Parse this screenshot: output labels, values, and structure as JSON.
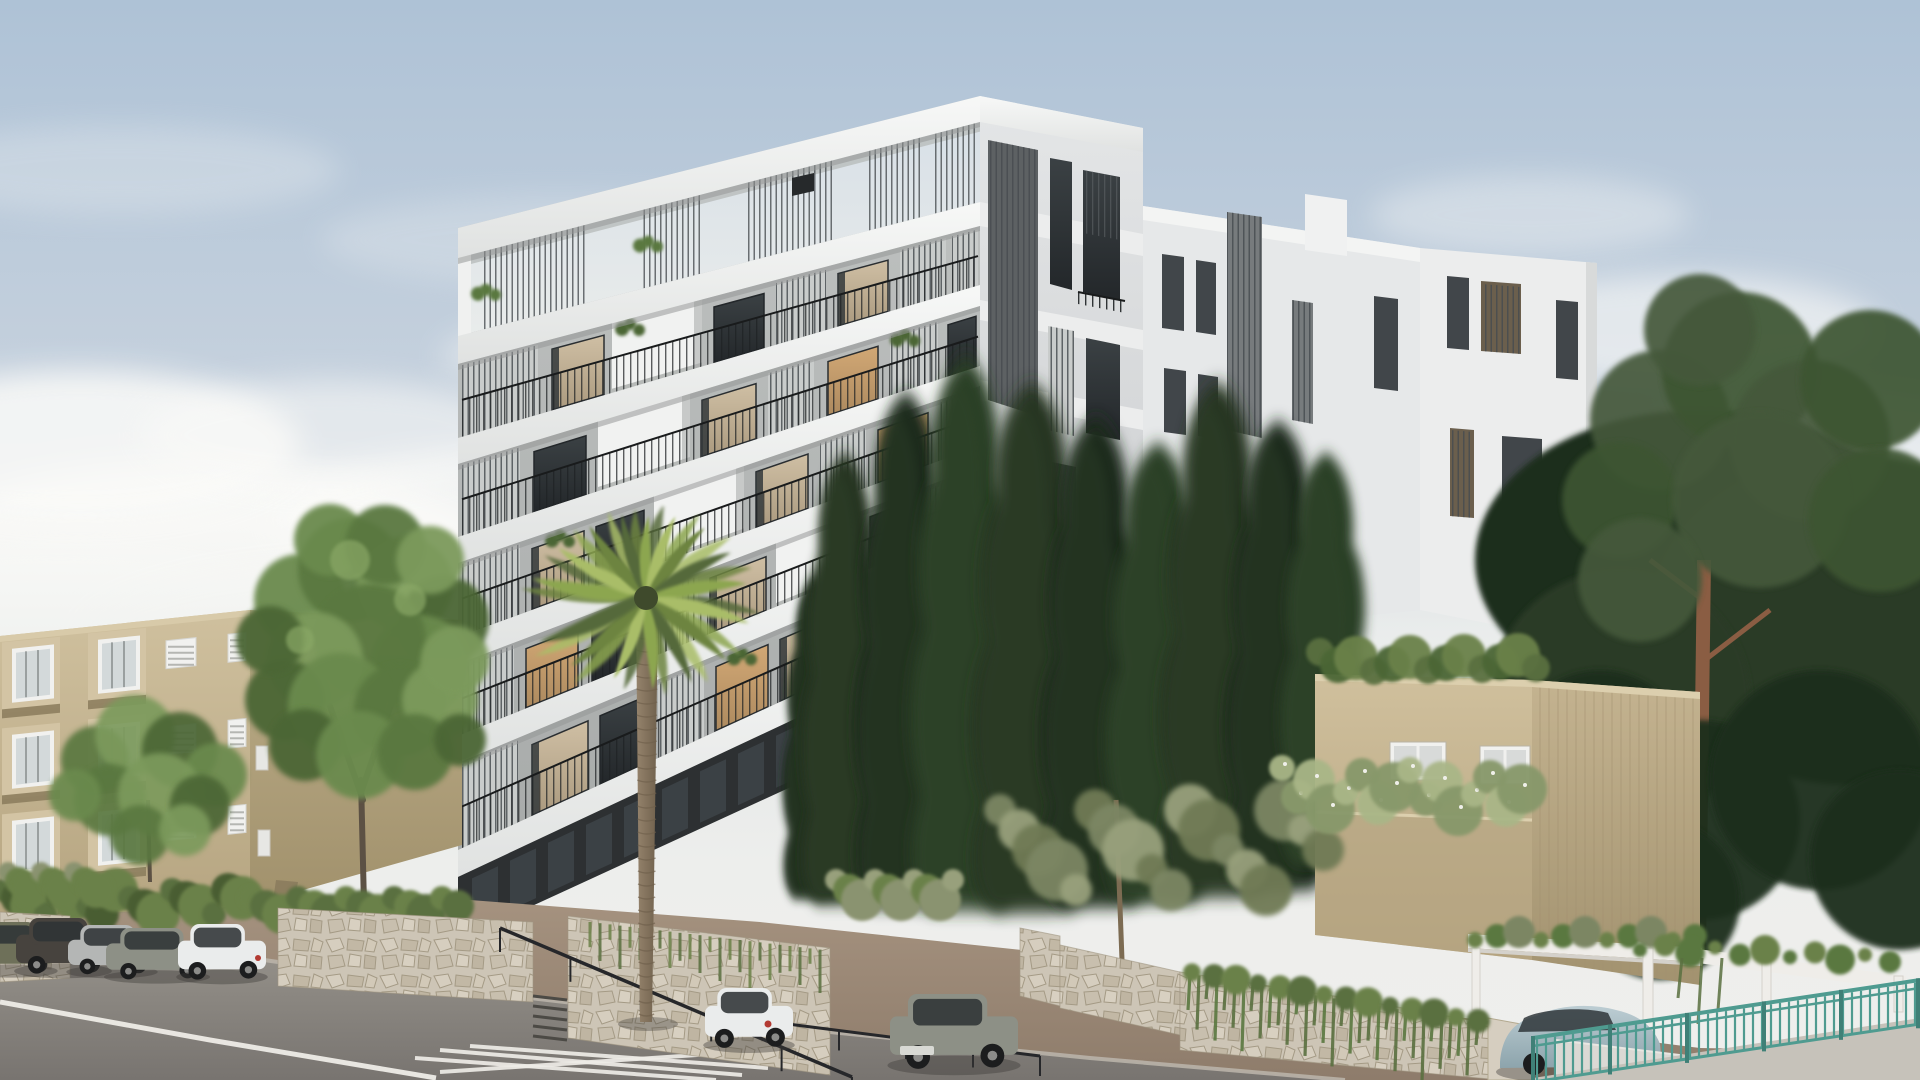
{
  "meta": {
    "title": "Architectural rendering: modern white apartment building street view",
    "scene_type": "photorealistic exterior visualization, daytime"
  },
  "palette": {
    "skyTop": "#aec2d6",
    "skyUpper": "#c7d2de",
    "skyMid": "#e3e6e7",
    "horizon": "#edeeec",
    "cloud": "#fafaf8",
    "slab": "#f4f5f4",
    "slabLow": "#e2e4e3",
    "slabShadow": "#959897",
    "wallGrey": "#b6b9b8",
    "wallGreyLight": "#c9cccb",
    "wallDeep": "#a7aaa9",
    "glassDark": "#383d40",
    "glassDeep": "#272b2d",
    "curtain": "#c9b99e",
    "curtainDark": "#b3a186",
    "litWindow": "#cda471",
    "louverLine": "#474c4f",
    "pickLine": "#1e2123",
    "groundFloor": "#2d3032",
    "groundPane": "#4a5257",
    "rightFace": "#d9dbdc",
    "rearA": "#e6e8e9",
    "rearB": "#eceded",
    "rearWin": "#41464a",
    "beigeFront": "#c7b794",
    "beigeSide": "#b0a17c",
    "bayBox": "#d3c4a4",
    "bayShadow": "#8d7e5e",
    "winWhite": "#f1f1ef",
    "winGlass": "#d3d9da",
    "strut": "#8d7e5f",
    "cantShadow": "#7b6d52",
    "houseFront": "#c9b996",
    "houseTall": "#bcab88",
    "houseTop": "#dccfae",
    "stone": "#cdc5b6",
    "stoneDark": "#b9af9d",
    "stoneLine": "#a49a85",
    "hedge1": "#5a7040",
    "hedge2": "#4a5d33",
    "hedge3": "#6b8148",
    "tree1": "#6b8a4e",
    "tree2": "#5a7840",
    "tree3": "#7b9a5c",
    "tree4": "#4c6636",
    "treeLight": "#8aa866",
    "cyp1": "#253521",
    "cyp2": "#1d2b1a",
    "cyp3": "#2c3f26",
    "cypHi": "#31452a",
    "olive1": "#7c8663",
    "olive2": "#98a07c",
    "olive3": "#6f7a55",
    "palm1": "#8ca64f",
    "palm2": "#a9bd68",
    "palm3": "#6d8440",
    "palm4": "#55693a",
    "palmCore": "#3f4a2c",
    "trunk": "#8b7962",
    "trunkDark": "#6e5f4c",
    "pineTrunk": "#8a5d43",
    "pine1": "#3c5430",
    "pine2": "#2a3b26",
    "pine3": "#1f2d1d",
    "pine4": "#44583a",
    "road": "#8a8683",
    "roadDark": "#7b7773",
    "roadEdge": "#b9b2a8",
    "roadLine": "#eeece7",
    "dirt": "#a08d7b",
    "dirtDark": "#8e7c6b",
    "teal": "#4f9b90",
    "pergola": "#efede9",
    "pergolaShade": "#d4d1cb",
    "railDark": "#26272a",
    "carWhite": "#eaecec",
    "carSilver": "#b4b6b5",
    "carGrey": "#8d9086",
    "carDark": "#47433e",
    "carOlive": "#6e7059",
    "carBlue": "#a7bdc5",
    "concrete": "#c6c2ba",
    "lowWall": "#dbd9d4"
  },
  "front": {
    "x0": 458,
    "x1": 980,
    "bottom": [
      940,
      700
    ],
    "bands": [
      [
        228,
        96,
        258,
        122
      ],
      [
        336,
        202,
        364,
        226
      ],
      [
        438,
        285,
        464,
        306
      ],
      [
        537,
        366,
        563,
        386
      ],
      [
        637,
        446,
        664,
        466
      ],
      [
        736,
        524,
        763,
        545
      ],
      [
        850,
        610,
        877,
        632
      ]
    ],
    "pergola": {
      "louvers": [
        [
          480,
          585
        ],
        [
          640,
          700
        ],
        [
          748,
          835
        ],
        [
          868,
          922
        ],
        [
          934,
          976
        ]
      ],
      "plants": [
        [
          486,
          0.5
        ],
        [
          648,
          0.42
        ]
      ],
      "slot": [
        792,
        178,
        22,
        18
      ]
    },
    "floors": [
      {
        "it": [
          [
            "lv",
            462,
            538,
            0.03,
            1
          ],
          [
            "wc",
            552,
            604,
            0.14,
            0.99
          ],
          [
            "wb",
            612,
            702,
            -0.05,
            1
          ],
          [
            "wd",
            714,
            764,
            0.16,
            0.99
          ],
          [
            "lv",
            776,
            826,
            0.05,
            1
          ],
          [
            "wc",
            838,
            888,
            0.16,
            0.99
          ],
          [
            "lv",
            900,
            946,
            0.05,
            1
          ],
          [
            "lv",
            952,
            978,
            0.05,
            1
          ],
          [
            "rl",
            462,
            978,
            0.5,
            1
          ],
          [
            "pl",
            630,
            0,
            0.08,
            0
          ]
        ]
      },
      {
        "it": [
          [
            "lv",
            462,
            520,
            0.03,
            1
          ],
          [
            "wd",
            534,
            586,
            0.15,
            0.99
          ],
          [
            "wb",
            598,
            690,
            -0.05,
            1
          ],
          [
            "wc",
            702,
            756,
            0.15,
            0.99
          ],
          [
            "lv",
            768,
            814,
            0.05,
            1
          ],
          [
            "wl",
            828,
            878,
            0.15,
            0.99
          ],
          [
            "lv",
            890,
            938,
            0.05,
            1
          ],
          [
            "wd",
            948,
            976,
            0.15,
            0.99
          ],
          [
            "rl",
            462,
            978,
            0.5,
            1
          ],
          [
            "pl",
            905,
            0,
            0.1,
            0
          ]
        ]
      },
      {
        "it": [
          [
            "lv",
            462,
            520,
            0.03,
            1
          ],
          [
            "wc",
            532,
            584,
            0.15,
            0.99
          ],
          [
            "wd",
            596,
            644,
            0.15,
            0.99
          ],
          [
            "wb",
            654,
            744,
            -0.05,
            1
          ],
          [
            "wc",
            756,
            808,
            0.15,
            0.99
          ],
          [
            "lv",
            820,
            866,
            0.05,
            1
          ],
          [
            "wl",
            878,
            928,
            0.15,
            0.99
          ],
          [
            "lv",
            940,
            976,
            0.05,
            1
          ],
          [
            "rl",
            462,
            978,
            0.5,
            1
          ],
          [
            "pl",
            560,
            0,
            0.1,
            0
          ]
        ]
      },
      {
        "it": [
          [
            "lv",
            462,
            514,
            0.03,
            1
          ],
          [
            "wl",
            526,
            578,
            0.15,
            0.99
          ],
          [
            "wd",
            592,
            638,
            0.15,
            0.99
          ],
          [
            "lv",
            650,
            698,
            0.05,
            1
          ],
          [
            "wc",
            710,
            766,
            0.15,
            0.99
          ],
          [
            "wb",
            776,
            858,
            -0.05,
            1
          ],
          [
            "wd",
            870,
            918,
            0.15,
            0.99
          ],
          [
            "lv",
            930,
            974,
            0.05,
            1
          ],
          [
            "rl",
            462,
            978,
            0.5,
            1
          ]
        ]
      },
      {
        "it": [
          [
            "lv",
            462,
            518,
            0.03,
            1
          ],
          [
            "wc",
            532,
            588,
            0.15,
            0.99
          ],
          [
            "wd",
            600,
            648,
            0.15,
            0.99
          ],
          [
            "lv",
            658,
            704,
            0.05,
            1
          ],
          [
            "wl",
            716,
            768,
            0.15,
            0.99
          ],
          [
            "wc",
            780,
            834,
            0.15,
            0.99
          ],
          [
            "lv",
            846,
            892,
            0.05,
            1
          ],
          [
            "wd",
            902,
            948,
            0.15,
            0.99
          ],
          [
            "lv",
            956,
            978,
            0.05,
            1
          ],
          [
            "rl",
            462,
            978,
            0.52,
            1
          ],
          [
            "pl",
            742,
            0,
            0.12,
            0
          ]
        ]
      }
    ]
  },
  "clouds": [
    [
      200,
      555,
      300,
      95,
      0.95
    ],
    [
      520,
      520,
      250,
      70,
      0.8
    ],
    [
      80,
      445,
      220,
      75,
      0.85
    ],
    [
      330,
      435,
      190,
      55,
      0.55
    ],
    [
      760,
      430,
      240,
      55,
      0.6
    ],
    [
      1010,
      400,
      210,
      45,
      0.5
    ],
    [
      620,
      355,
      180,
      40,
      0.4
    ],
    [
      1680,
      330,
      200,
      55,
      0.6
    ],
    [
      1820,
      440,
      180,
      55,
      0.6
    ],
    [
      1530,
      215,
      160,
      40,
      0.35
    ],
    [
      1240,
      330,
      170,
      40,
      0.3
    ],
    [
      120,
      170,
      220,
      45,
      0.25
    ],
    [
      560,
      240,
      240,
      45,
      0.22
    ],
    [
      900,
      200,
      200,
      40,
      0.18
    ],
    [
      60,
      640,
      280,
      90,
      1
    ],
    [
      400,
      640,
      320,
      80,
      0.9
    ]
  ],
  "cypresses": [
    [
      815,
      905,
      330,
      70,
      1
    ],
    [
      845,
      912,
      460,
      95,
      0
    ],
    [
      906,
      916,
      525,
      112,
      1
    ],
    [
      966,
      920,
      565,
      122,
      2
    ],
    [
      1032,
      922,
      540,
      130,
      0
    ],
    [
      1096,
      916,
      500,
      120,
      1
    ],
    [
      1158,
      912,
      470,
      115,
      2
    ],
    [
      1218,
      906,
      525,
      125,
      0
    ],
    [
      1278,
      900,
      480,
      115,
      1
    ],
    [
      1326,
      872,
      420,
      100,
      2
    ]
  ],
  "carsLeft": [
    [
      -28,
      922,
      84,
      48,
      "carOlive"
    ],
    [
      16,
      918,
      94,
      52,
      "carDark"
    ],
    [
      68,
      925,
      88,
      46,
      "carSilver"
    ],
    [
      106,
      928,
      102,
      48,
      "carGrey"
    ],
    [
      178,
      924,
      88,
      52,
      "carWhite"
    ]
  ],
  "treeBlobs1": [
    [
      300,
      600,
      46
    ],
    [
      350,
      570,
      52
    ],
    [
      405,
      585,
      48
    ],
    [
      445,
      620,
      44
    ],
    [
      420,
      665,
      50
    ],
    [
      370,
      640,
      56
    ],
    [
      315,
      660,
      48
    ],
    [
      285,
      700,
      40
    ],
    [
      340,
      705,
      52
    ],
    [
      400,
      710,
      46
    ],
    [
      440,
      700,
      38
    ],
    [
      305,
      745,
      36
    ],
    [
      360,
      755,
      44
    ],
    [
      415,
      752,
      38
    ],
    [
      455,
      660,
      34
    ],
    [
      270,
      640,
      34
    ],
    [
      330,
      540,
      36
    ],
    [
      385,
      545,
      40
    ],
    [
      430,
      560,
      34
    ],
    [
      460,
      740,
      26
    ]
  ],
  "treeBlobs2": [
    [
      95,
      760,
      34
    ],
    [
      135,
      735,
      40
    ],
    [
      180,
      750,
      38
    ],
    [
      215,
      775,
      32
    ],
    [
      110,
      800,
      36
    ],
    [
      160,
      795,
      42
    ],
    [
      200,
      805,
      30
    ],
    [
      75,
      795,
      26
    ],
    [
      140,
      835,
      30
    ],
    [
      185,
      830,
      26
    ]
  ],
  "palm": {
    "cx": 646,
    "cy": 598,
    "angles": [
      -170,
      -150,
      -128,
      -106,
      -88,
      -70,
      -50,
      -28,
      -8,
      14,
      38,
      62,
      86,
      112,
      138,
      158
    ],
    "scales": [
      1.2,
      1.05,
      0.95,
      0.9,
      0.85,
      0.9,
      0.95,
      1.0,
      1.05,
      1.1,
      1.05,
      1.0,
      0.95,
      0.9,
      1.05,
      1.2
    ],
    "trunkTop": 610,
    "trunkBottom": 1022
  },
  "fence": {
    "x0": 1533,
    "y0": 1038,
    "x1": 1920,
    "y1": 980,
    "drop": 44,
    "step": 9
  },
  "ivyHeights": [
    36,
    54,
    22,
    62,
    30,
    46,
    68,
    26,
    52,
    40
  ]
}
